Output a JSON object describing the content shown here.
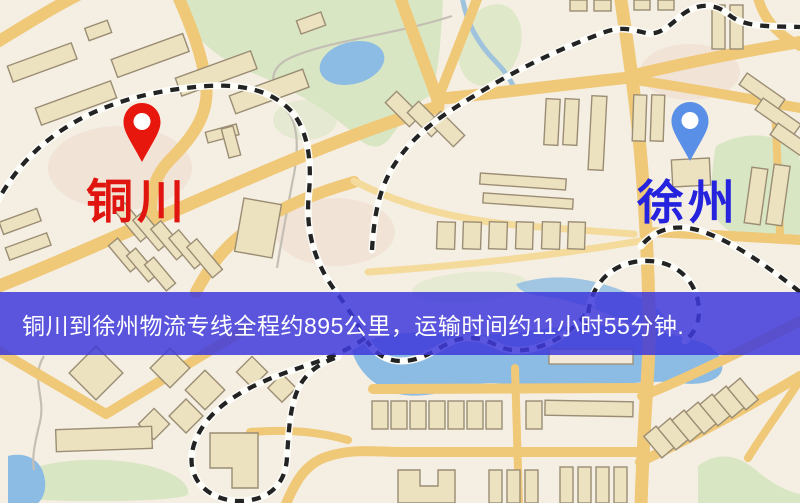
{
  "banner": {
    "text": "铜川到徐州物流专线全程约895公里，运输时间约11小时55分钟.",
    "origin_city": "铜川",
    "destination_city": "徐州",
    "distance_text": "约895公里",
    "duration_text": "约11小时55分钟",
    "background": "#3E3ADA",
    "opacity": "0.85",
    "text_color": "#FFFFFF"
  },
  "markers": {
    "origin": {
      "label": "铜川",
      "pin_color": "#E8170D",
      "label_color": "#E0150F"
    },
    "destination": {
      "label": "徐州",
      "pin_color": "#5A8FE8",
      "label_color": "#2523DE"
    }
  },
  "map": {
    "background": "#F5EEE2",
    "road_color": "#EFC878",
    "minor_road_color": "#F4DB9C",
    "park_color": "#D9E6C3",
    "water_color": "#8CBCE4",
    "building_fill": "#EDE2C0",
    "railway_dash_color": "#232323"
  }
}
